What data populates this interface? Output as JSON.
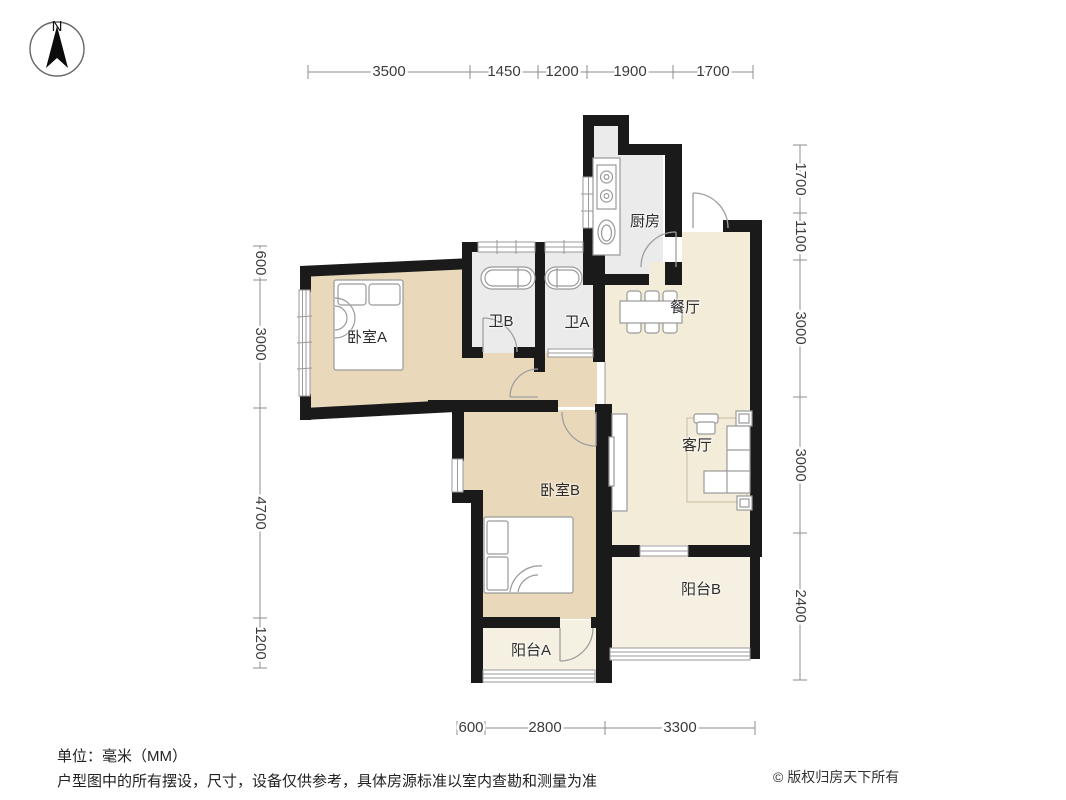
{
  "compass": {
    "label": "N"
  },
  "rooms": {
    "bedroom_a": "卧室A",
    "bedroom_b": "卧室B",
    "bath_b": "卫B",
    "bath_a": "卫A",
    "kitchen": "厨房",
    "dining": "餐厅",
    "living": "客厅",
    "balcony_a": "阳台A",
    "balcony_b": "阳台B"
  },
  "dimensions": {
    "top": [
      "3500",
      "1450",
      "1200",
      "1900",
      "1700"
    ],
    "left": [
      "600",
      "3000",
      "4700",
      "1200"
    ],
    "right": [
      "1700",
      "1100",
      "3000",
      "3000",
      "2400"
    ],
    "bottom": [
      "600",
      "2800",
      "3300"
    ]
  },
  "footer": {
    "unit": "单位：毫米（MM）",
    "disclaimer": "户型图中的所有摆设，尺寸，设备仅供参考，具体房源标准以室内查勘和测量为准",
    "copyright": "© 版权归房天下所有"
  },
  "colors": {
    "wall": "#1a1a1a",
    "floor_bedroom": "#ead8ba",
    "floor_public": "#f3ecd9",
    "floor_service": "#ebebeb",
    "floor_balcony": "#f5f0e1",
    "dim_line": "#8c8c8c",
    "label_text": "#2e2e2e"
  }
}
